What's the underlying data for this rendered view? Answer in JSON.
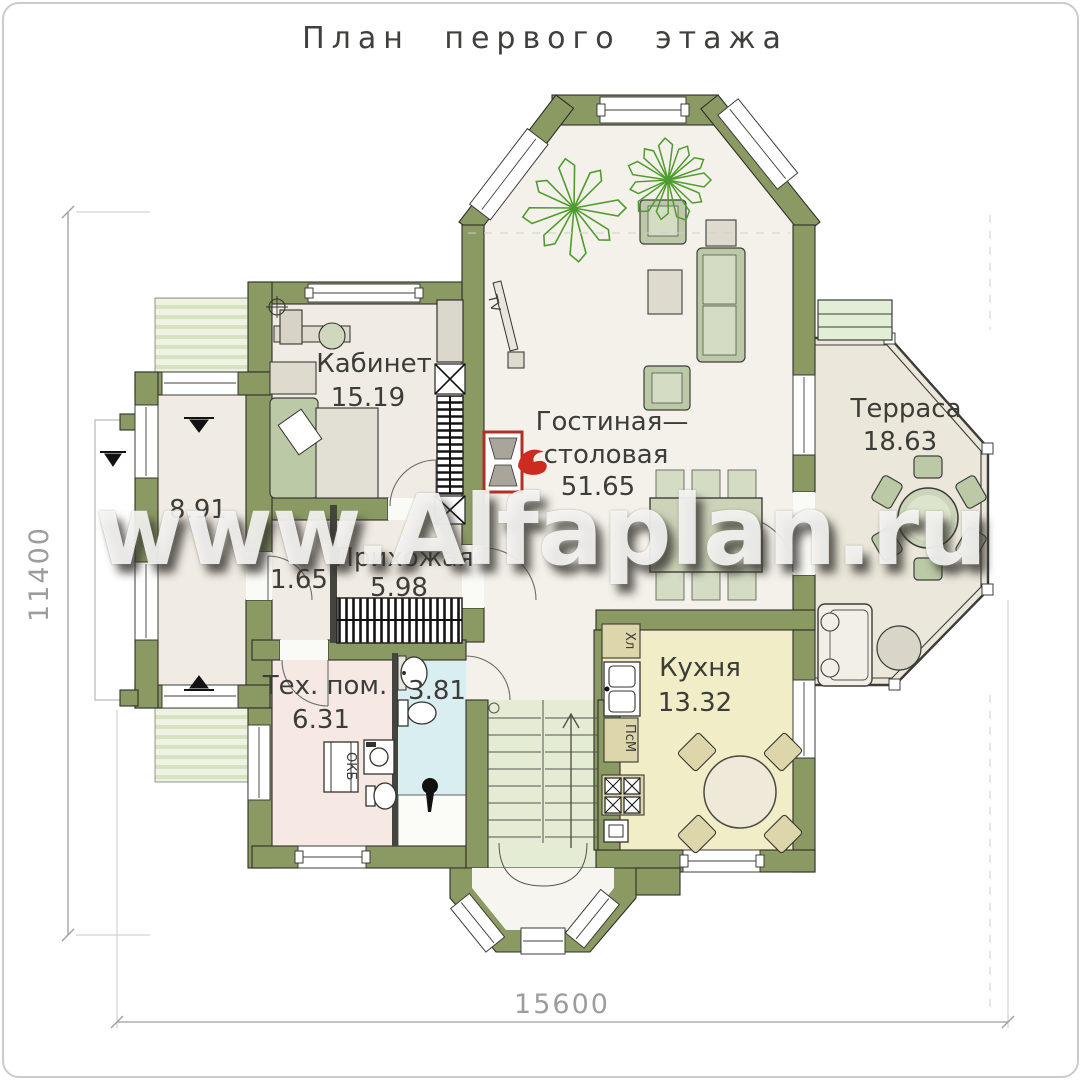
{
  "title": "План первого этажа",
  "watermark": "www.Alfaplan.ru",
  "dimensions": {
    "vertical": "11400",
    "horizontal": "15600"
  },
  "rooms": {
    "office": {
      "name": "Кабинет",
      "area": "15.19"
    },
    "living": {
      "name_line1": "Гостиная—",
      "name_line2": "столовая",
      "area": "51.65"
    },
    "terrace": {
      "name": "Терраса",
      "area": "18.63"
    },
    "hallway": {
      "name": "Прихожая",
      "area": "5.98"
    },
    "corridor": {
      "area": "1.65"
    },
    "side_room": {
      "area": "8.91"
    },
    "tech_room": {
      "name": "Тех. пом.",
      "area": "6.31"
    },
    "bathroom": {
      "area": "3.81"
    },
    "kitchen": {
      "name": "Кухня",
      "area": "13.32"
    }
  },
  "labels": {
    "tv": "TV",
    "fridge": "Хл",
    "dishwasher": "ПсМ",
    "boiler": "ОКБ"
  },
  "colors": {
    "wall": "#8b9a63",
    "floor": "#f4f1ea",
    "kitchen_floor": "#f1edc6",
    "bath_floor": "#d9eef0",
    "tech_floor": "#f6e9e4",
    "stairs_floor": "#e4ecd4",
    "terrace_floor": "#ebe7da",
    "porch_deck": "#e7edd9",
    "fireplace_red": "#c0291c",
    "plant_green": "#4f9c2e",
    "dim_gray": "#9d9d9d"
  }
}
